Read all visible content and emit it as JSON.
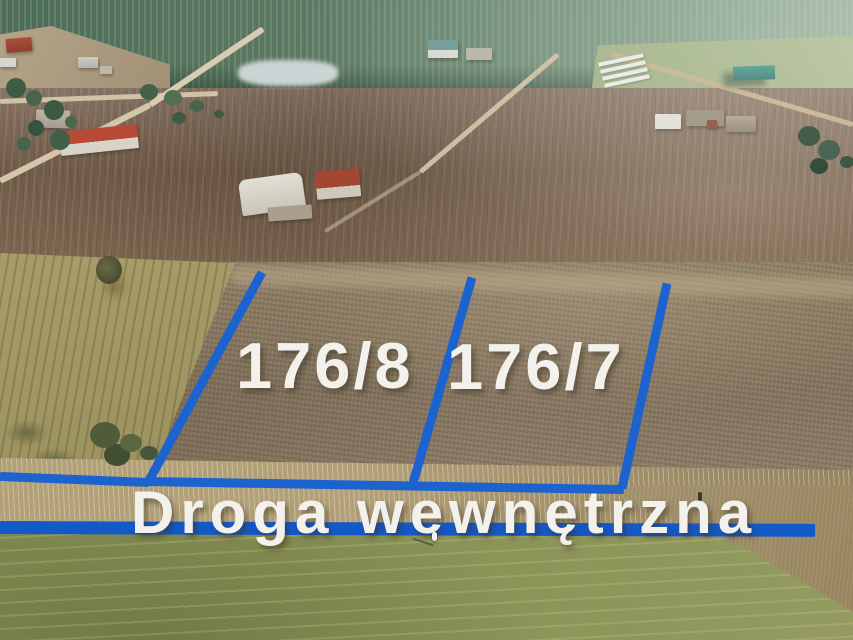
{
  "scene": {
    "labels": {
      "plot_left": "176/8",
      "plot_right": "176/7",
      "road": "Droga wewnętrzna"
    },
    "colors": {
      "boundary_blue": "#1c63cf",
      "road_line_blue": "#1459c8",
      "label_white": "#f2f1ec"
    }
  }
}
